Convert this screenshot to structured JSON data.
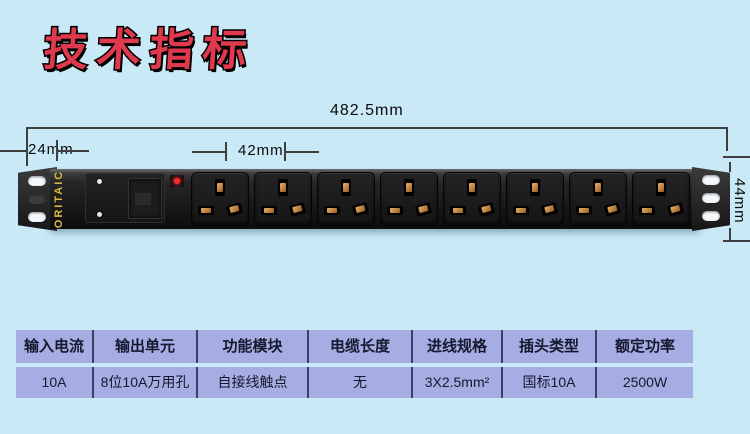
{
  "title": {
    "text": "技术指标"
  },
  "diagram": {
    "total_width_label": "482.5mm",
    "left_offset_label": "24mm",
    "socket_pitch_label": "42mm",
    "height_label": "44mm",
    "brand": "ORITAIC",
    "socket_count": 8
  },
  "table": {
    "columns": [
      {
        "header": "输入电流",
        "value": "10A"
      },
      {
        "header": "输出单元",
        "value": "8位10A万用孔"
      },
      {
        "header": "功能模块",
        "value": "自接线触点"
      },
      {
        "header": "电缆长度",
        "value": "无"
      },
      {
        "header": "进线规格",
        "value": "3X2.5mm²"
      },
      {
        "header": "插头类型",
        "value": "国标10A"
      },
      {
        "header": "额定功率",
        "value": "2500W"
      }
    ]
  },
  "colors": {
    "background": "#c9e9f7",
    "title_red": "#e0384c",
    "table_cell": "#a6ade2",
    "table_divider": "#3a4066",
    "brand_yellow": "#d8b93c",
    "led_red": "#ff2b2b"
  }
}
